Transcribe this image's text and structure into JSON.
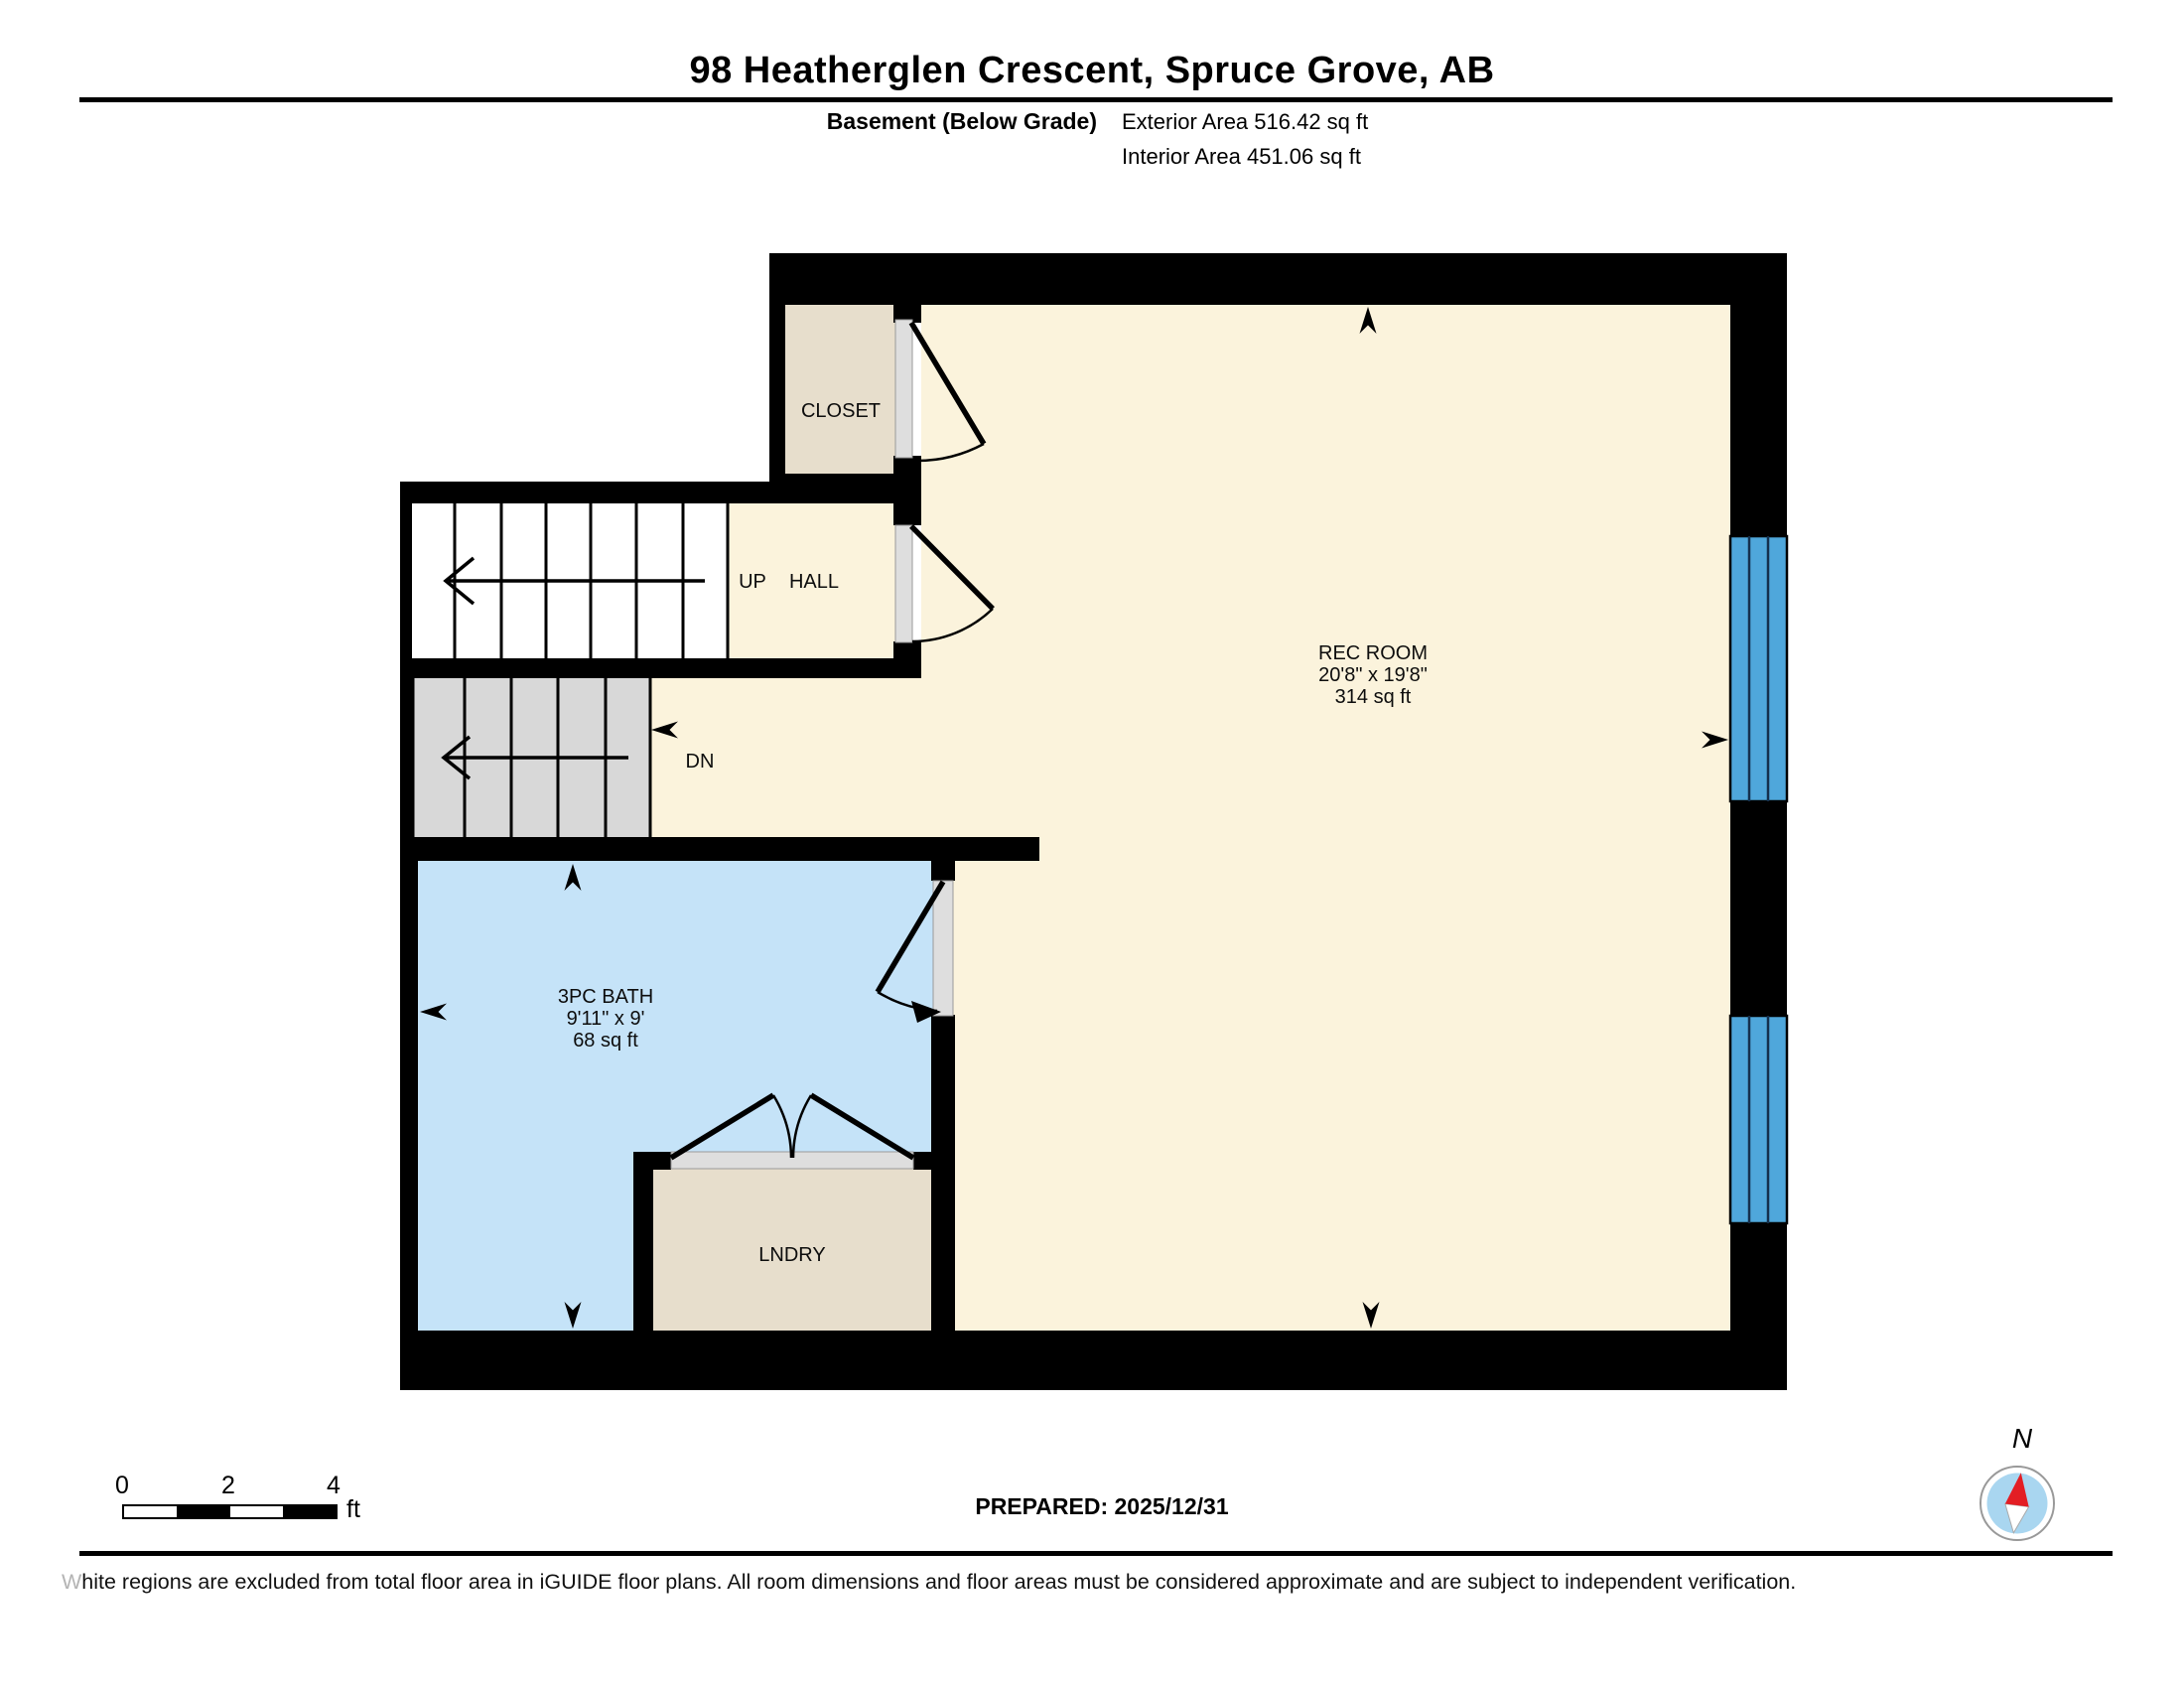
{
  "header": {
    "title": "98 Heatherglen Crescent, Spruce Grove, AB",
    "floor_label": "Basement (Below Grade)",
    "exterior_area": "Exterior Area 516.42 sq ft",
    "interior_area": "Interior Area 451.06 sq ft"
  },
  "rooms": {
    "closet": {
      "label": "CLOSET"
    },
    "hall": {
      "label": "HALL"
    },
    "rec_room": {
      "label": "REC ROOM",
      "dimensions": "20'8\" x 19'8\"",
      "area": "314 sq ft"
    },
    "bath": {
      "label": "3PC BATH",
      "dimensions": "9'11\" x 9'",
      "area": "68 sq ft"
    },
    "laundry": {
      "label": "LNDRY"
    }
  },
  "stairs": {
    "up": "UP",
    "down": "DN"
  },
  "scale_bar": {
    "ticks": [
      "0",
      "2",
      "4"
    ],
    "unit": "ft"
  },
  "compass": {
    "north_label": "N"
  },
  "footer": {
    "prepared": "PREPARED: 2025/12/31",
    "disclaimer_lead": "W",
    "disclaimer_rest": "hite regions are excluded from total floor area in iGUIDE floor plans. All room dimensions and floor areas must be considered approximate and are subject to independent verification."
  },
  "colors": {
    "floor": "#FBF3DC",
    "closet-floor": "#E7DECC",
    "bath-floor": "#C5E3F8",
    "window": "#4FA7DB",
    "stair-tread": "#D8D8D8",
    "door-jamb": "#DEDEDE",
    "wall": "#000000",
    "compass-fill": "#A9D6F0",
    "compass-needle": "#E31E24"
  }
}
